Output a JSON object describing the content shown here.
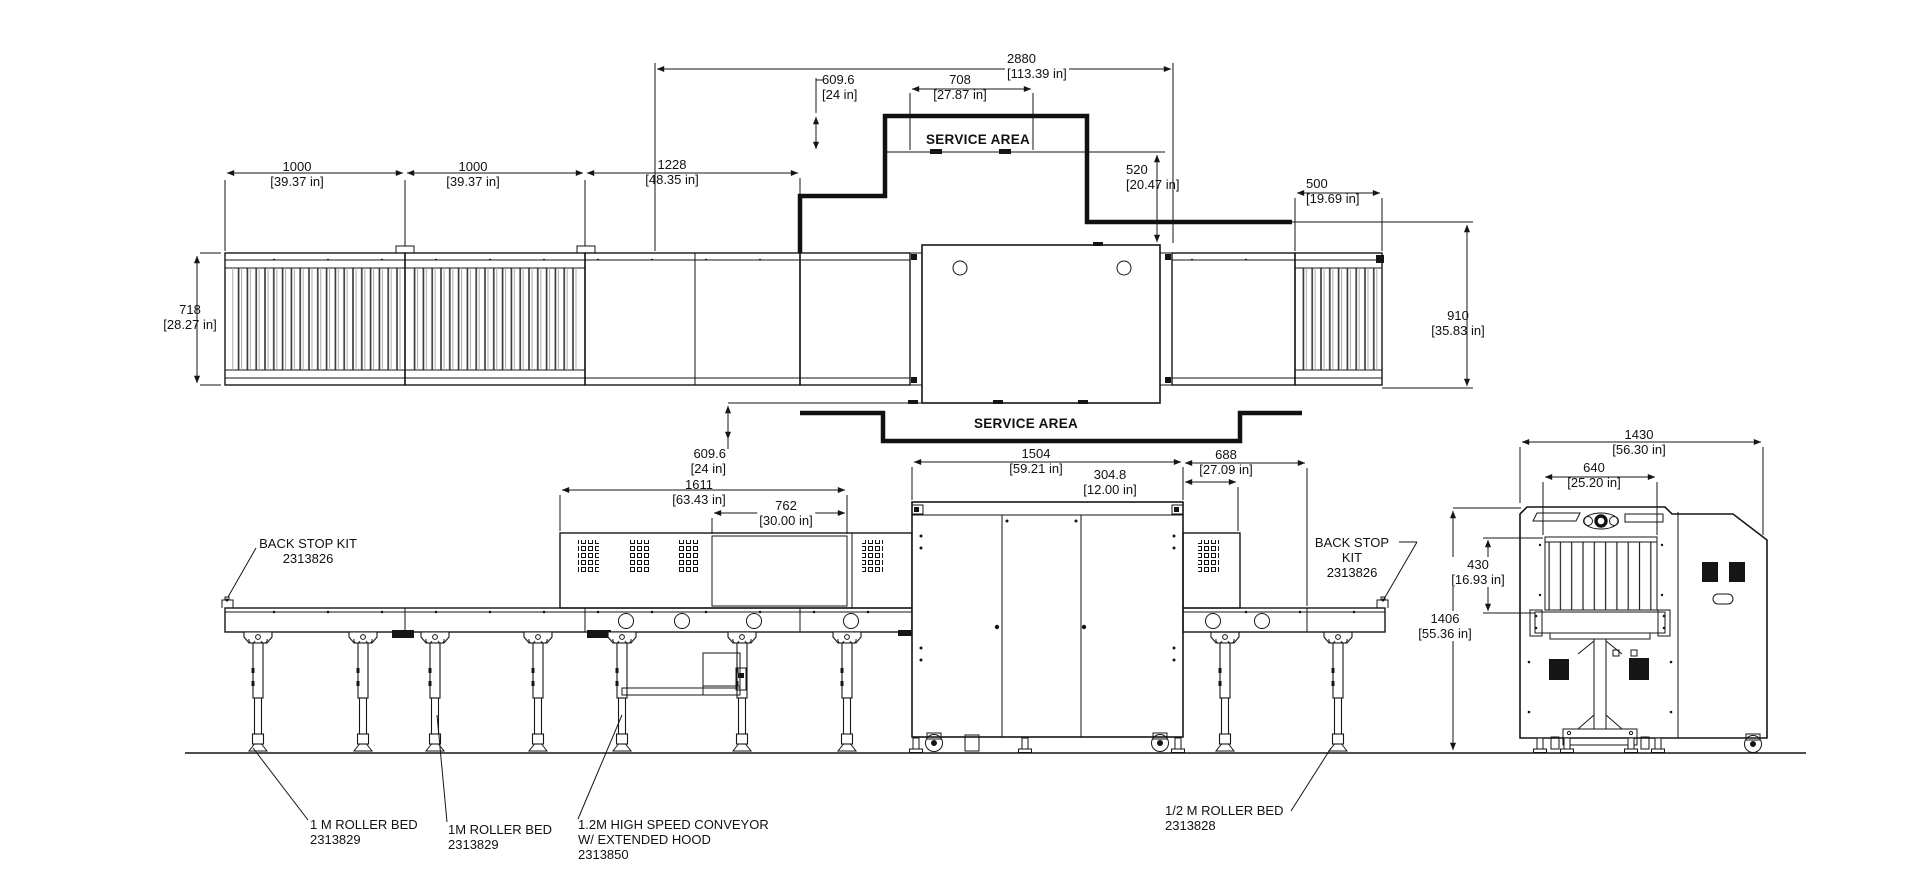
{
  "dims": {
    "len_1000_a": {
      "mm": "1000",
      "inch": "[39.37 in]"
    },
    "len_1000_b": {
      "mm": "1000",
      "inch": "[39.37 in]"
    },
    "len_1228": {
      "mm": "1228",
      "inch": "[48.35 in]"
    },
    "len_2880": {
      "mm": "2880",
      "inch": "[113.39 in]"
    },
    "len_609_top": {
      "mm": "609.6",
      "inch": "[24 in]"
    },
    "len_708": {
      "mm": "708",
      "inch": "[27.87 in]"
    },
    "len_520": {
      "mm": "520",
      "inch": "[20.47 in]"
    },
    "len_500": {
      "mm": "500",
      "inch": "[19.69 in]"
    },
    "wid_718": {
      "mm": "718",
      "inch": "[28.27 in]"
    },
    "wid_910": {
      "mm": "910",
      "inch": "[35.83 in]"
    },
    "len_609_bot": {
      "mm": "609.6",
      "inch": "[24 in]"
    },
    "len_1611": {
      "mm": "1611",
      "inch": "[63.43 in]"
    },
    "len_762": {
      "mm": "762",
      "inch": "[30.00 in]"
    },
    "len_1504": {
      "mm": "1504",
      "inch": "[59.21 in]"
    },
    "len_304": {
      "mm": "304.8",
      "inch": "[12.00 in]"
    },
    "len_688": {
      "mm": "688",
      "inch": "[27.09 in]"
    },
    "wid_1430": {
      "mm": "1430",
      "inch": "[56.30 in]"
    },
    "wid_640": {
      "mm": "640",
      "inch": "[25.20 in]"
    },
    "hgt_430": {
      "mm": "430",
      "inch": "[16.93 in]"
    },
    "hgt_1406": {
      "mm": "1406",
      "inch": "[55.36 in]"
    }
  },
  "service_area": {
    "top": "SERVICE AREA",
    "bottom": "SERVICE AREA"
  },
  "part_labels": {
    "back_stop_left": {
      "line1": "BACK STOP KIT",
      "part": "2313826"
    },
    "back_stop_right": {
      "line1": "BACK STOP",
      "line2": "KIT",
      "part": "2313826"
    },
    "roller_bed_1": {
      "line1": "1 M ROLLER BED",
      "part": "2313829"
    },
    "roller_bed_2": {
      "line1": "1M ROLLER BED",
      "part": "2313829"
    },
    "high_speed_conveyor": {
      "line1": "1.2M HIGH SPEED CONVEYOR",
      "line2": "W/ EXTENDED HOOD",
      "part": "2313850"
    },
    "half_roller_bed": {
      "line1": "1/2 M ROLLER BED",
      "part": "2313828"
    }
  },
  "colors": {
    "line": "#161616",
    "background": "#ffffff"
  }
}
